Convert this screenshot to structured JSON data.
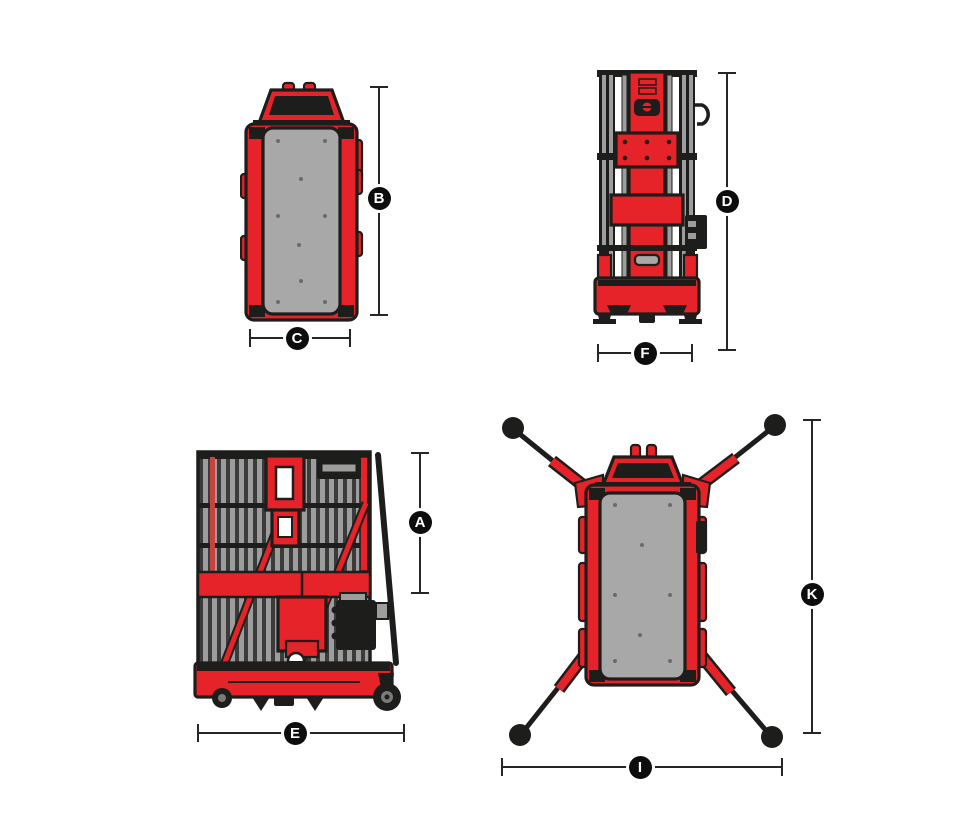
{
  "diagram": {
    "title": "Vertical mast lift dimensions diagram",
    "colors": {
      "machine_red": "#e62329",
      "outline_black": "#1d1d1b",
      "platform_gray": "#a8a8a8",
      "dimension_line": "#262626",
      "label_background": "#0d0d0d",
      "label_text": "#ffffff"
    },
    "views": [
      {
        "name": "top-view-stowed",
        "dimension_refs": [
          "B",
          "C"
        ]
      },
      {
        "name": "front-view-mast",
        "dimension_refs": [
          "D",
          "F"
        ]
      },
      {
        "name": "side-view-stowed",
        "dimension_refs": [
          "A",
          "E"
        ]
      },
      {
        "name": "top-view-outriggers-extended",
        "dimension_refs": [
          "K",
          "I"
        ]
      }
    ],
    "dimension_labels": {
      "A": "A",
      "B": "B",
      "C": "C",
      "D": "D",
      "E": "E",
      "F": "F",
      "I": "I",
      "K": "K"
    }
  }
}
